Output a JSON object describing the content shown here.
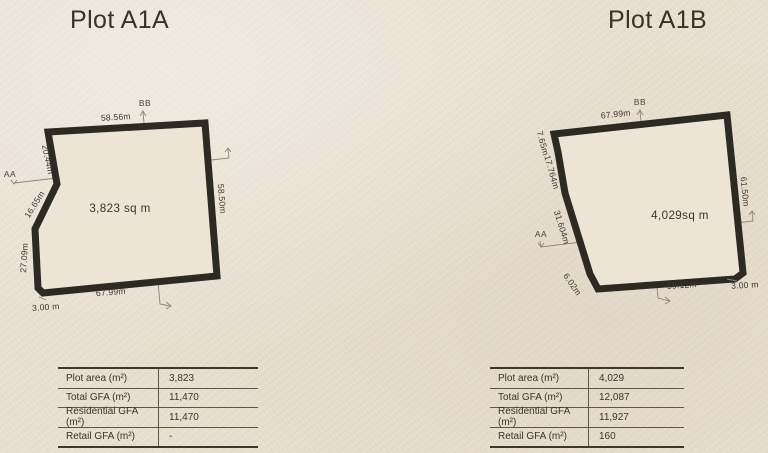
{
  "colors": {
    "paper": "#e9e1d2",
    "outline_ink": "#2d2923",
    "thin_line": "#8d8477",
    "text": "#3a352b"
  },
  "plots": [
    {
      "title": "Plot A1A",
      "section_bb": "BB",
      "section_aa": "AA",
      "area": "3,823 sq m",
      "dims": {
        "top": "58.56m",
        "right": "58.50m",
        "bottom": "67.99m",
        "corner": "3.00 m",
        "left_upper": "20.44m",
        "left_mid": "16.65m",
        "left_lower": "27.09m"
      },
      "table": {
        "rows": [
          {
            "label": "Plot area (m²)",
            "value": "3,823"
          },
          {
            "label": "Total GFA (m²)",
            "value": "11,470"
          },
          {
            "label": "Residential GFA (m²)",
            "value": "11,470"
          },
          {
            "label": "Retail GFA (m²)",
            "value": "-"
          }
        ]
      }
    },
    {
      "title": "Plot A1B",
      "section_bb": "BB",
      "section_aa": "AA",
      "area": "4,029sq m",
      "dims": {
        "top": "67.99m",
        "right": "61.50m",
        "bottom": "59.12m",
        "corner": "3.00 m",
        "left_upper": "7.65m",
        "left_mid": "17.764m",
        "left_lower": "31.604m",
        "bottom_left": "6.02m"
      },
      "table": {
        "rows": [
          {
            "label": "Plot area (m²)",
            "value": "4,029"
          },
          {
            "label": "Total GFA (m²)",
            "value": "12,087"
          },
          {
            "label": "Residential GFA (m²)",
            "value": "11,927"
          },
          {
            "label": "Retail GFA (m²)",
            "value": "160"
          }
        ]
      }
    }
  ]
}
